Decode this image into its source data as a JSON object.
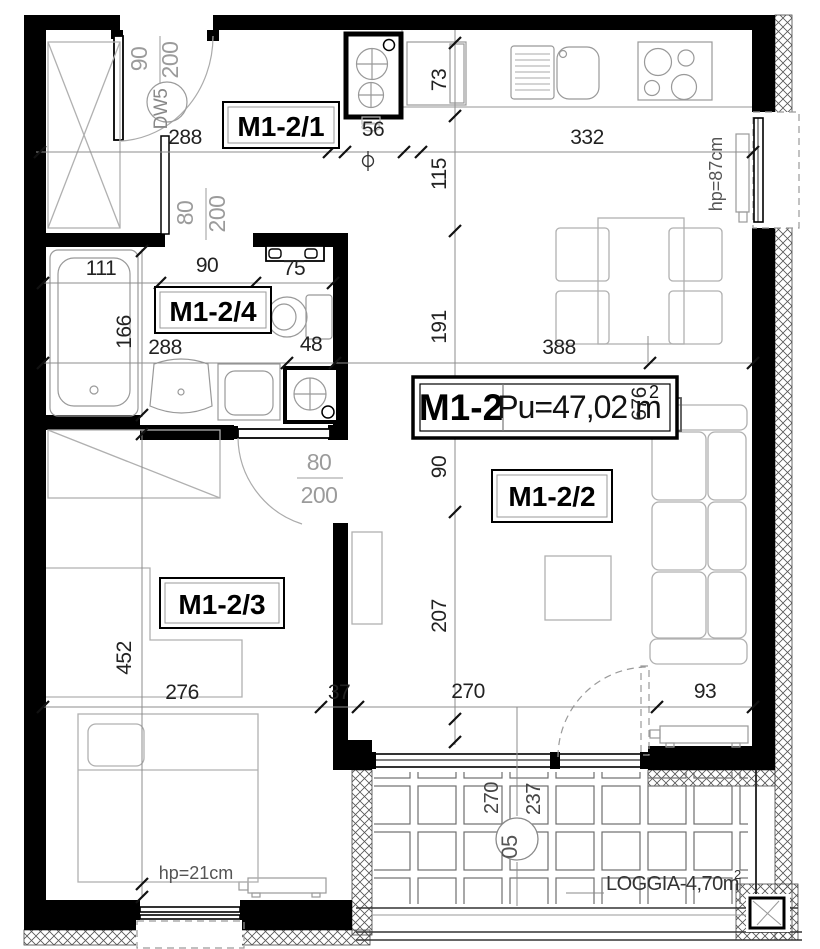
{
  "unit": {
    "id": "M1-2",
    "area": "Pu=47,02 m",
    "area_sup": "2"
  },
  "rooms": {
    "hall": "M1-2/1",
    "living": "M1-2/2",
    "bedroom": "M1-2/3",
    "bathroom": "M1-2/4"
  },
  "doors": {
    "entry_code": "DW5",
    "entry_width": "90",
    "entry_height": "200",
    "bathroom_width": "80",
    "bathroom_height": "200",
    "bedroom_width": "80",
    "bedroom_height": "200"
  },
  "windows": {
    "kitchen_parapet": "hp=87cm",
    "bedroom_parapet": "hp=21cm"
  },
  "loggia": {
    "label": "LOGGIA-4,70m",
    "label_sup": "2",
    "number": "05",
    "width": "270",
    "depth": "237"
  },
  "dims": {
    "top": [
      "288",
      "56",
      "332"
    ],
    "left_chain": [
      "73",
      "115",
      "191",
      "90",
      "207"
    ],
    "bathroom_top": [
      "111",
      "90",
      "75"
    ],
    "bathroom_height": "166",
    "middle": [
      "288",
      "48",
      "388"
    ],
    "living_height": "676",
    "bedroom_height": "452",
    "bottom": [
      "276",
      "37",
      "270",
      "93"
    ]
  }
}
